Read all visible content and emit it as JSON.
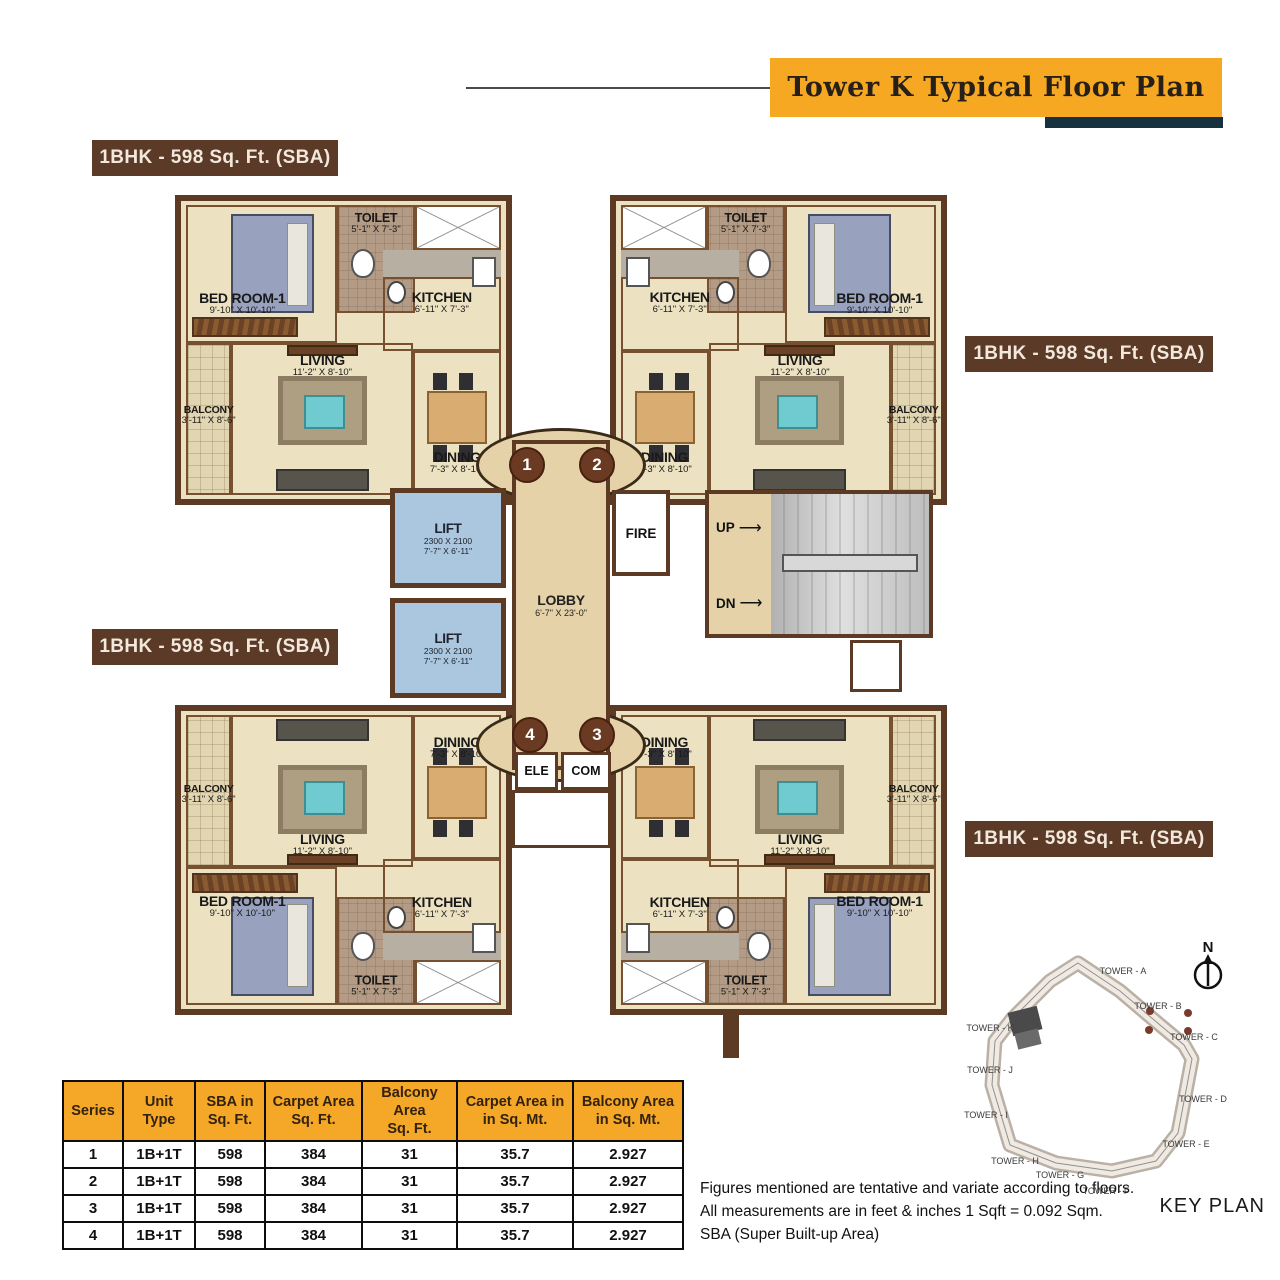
{
  "header": {
    "title": "Tower  K  Typical Floor Plan"
  },
  "plan": {
    "unit_area_label": "1BHK - 598 Sq. Ft. (SBA)",
    "rooms": {
      "bedroom": {
        "name": "BED ROOM-1",
        "dims": "9'-10\" X 10'-10\""
      },
      "toilet": {
        "name": "TOILET",
        "dims": "5'-1\" X 7'-3\""
      },
      "kitchen": {
        "name": "KITCHEN",
        "dims": "6'-11\" X 7'-3\""
      },
      "living": {
        "name": "LIVING",
        "dims": "11'-2\" X 8'-10\""
      },
      "dining": {
        "name": "DINING",
        "dims": "7'-3\" X 8'-10\""
      },
      "balcony": {
        "name": "BALCONY",
        "dims": "3'-11\" X 8'-6\""
      }
    },
    "core": {
      "lift": {
        "name": "LIFT",
        "dims1": "2300 X 2100",
        "dims2": "7'-7\" X 6'-11\""
      },
      "lobby": {
        "name": "LOBBY",
        "dims": "6'-7\" X 23'-0\""
      },
      "fire": "FIRE",
      "up": "UP",
      "dn": "DN",
      "ele": "ELE",
      "com": "COM",
      "unit_numbers": [
        "1",
        "2",
        "3",
        "4"
      ]
    }
  },
  "table": {
    "headers": [
      [
        "Series",
        ""
      ],
      [
        "Unit",
        "Type"
      ],
      [
        "SBA  in",
        "Sq. Ft."
      ],
      [
        "Carpet Area",
        "Sq. Ft."
      ],
      [
        "Balcony Area",
        "Sq. Ft."
      ],
      [
        "Carpet Area in",
        "in Sq. Mt."
      ],
      [
        "Balcony Area",
        "in Sq. Mt."
      ]
    ],
    "rows": [
      [
        "1",
        "1B+1T",
        "598",
        "384",
        "31",
        "35.7",
        "2.927"
      ],
      [
        "2",
        "1B+1T",
        "598",
        "384",
        "31",
        "35.7",
        "2.927"
      ],
      [
        "3",
        "1B+1T",
        "598",
        "384",
        "31",
        "35.7",
        "2.927"
      ],
      [
        "4",
        "1B+1T",
        "598",
        "384",
        "31",
        "35.7",
        "2.927"
      ]
    ]
  },
  "notes": {
    "line1": "Figures mentioned are tentative and variate according to floors.",
    "line2": "All measurements are in feet & inches 1 Sqft = 0.092 Sqm.",
    "line3": "SBA (Super Built-up Area)"
  },
  "keyplan": {
    "label": "KEY PLAN",
    "north": "N",
    "towers": [
      "TOWER - A",
      "TOWER - B",
      "TOWER - C",
      "TOWER - D",
      "TOWER - E",
      "TOWER - F",
      "TOWER - G",
      "TOWER - H",
      "TOWER - I",
      "TOWER - J",
      "TOWER - K"
    ]
  },
  "colors": {
    "banner_orange": "#F6A823",
    "navy_bar": "#16323F",
    "label_brown": "#5C3A28",
    "wall_brown": "#5D3A24",
    "floor_cream": "#ECE2C2",
    "lift_blue": "#ABC6DF",
    "lobby_tan": "#E5D2A8",
    "circle_brown": "#6B3A22",
    "table_header_orange": "#F5A728"
  }
}
